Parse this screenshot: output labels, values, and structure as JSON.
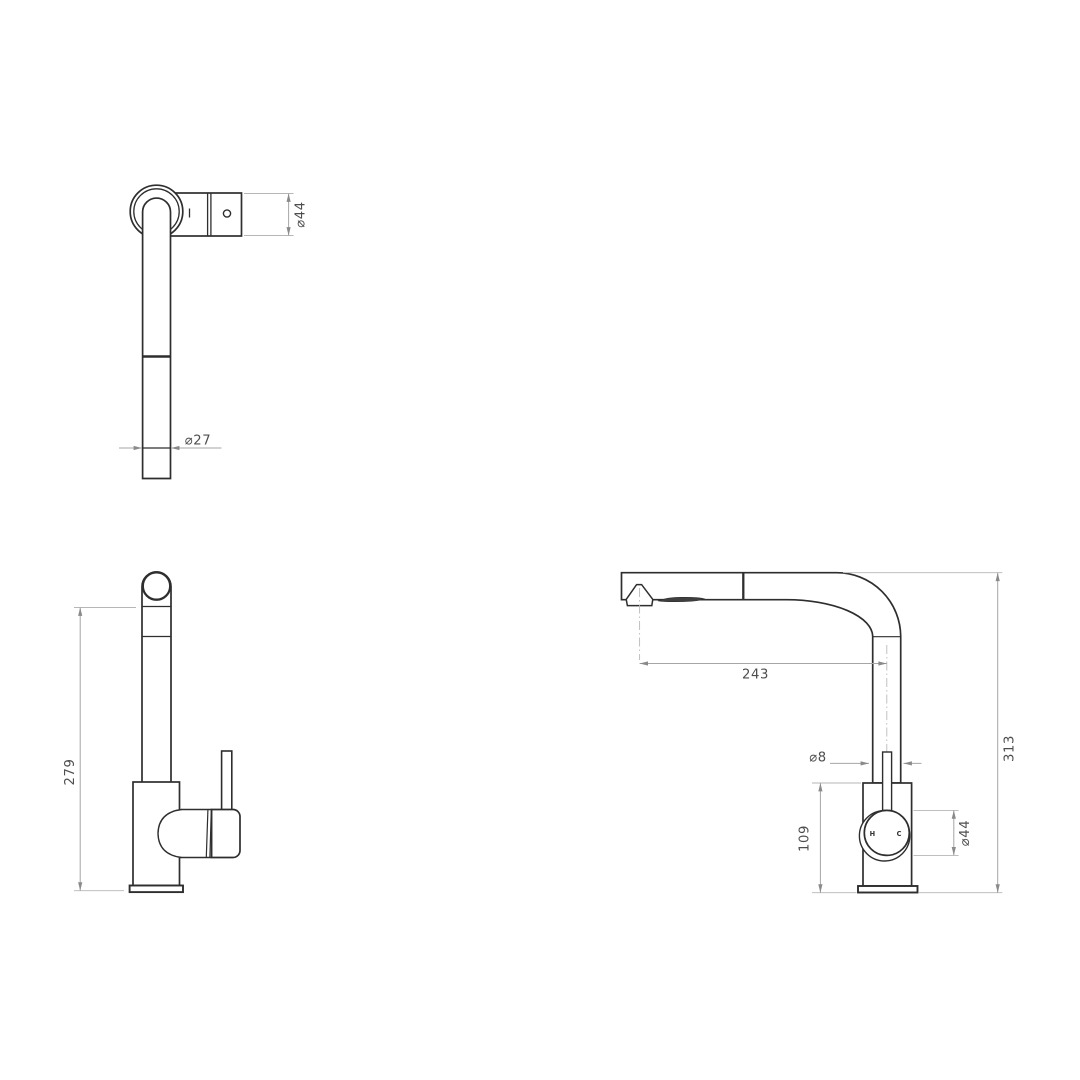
{
  "page": {
    "background": "#ffffff",
    "object_line_color": "#2e2e2e",
    "dimension_line_color": "#a6a6a6",
    "dimension_text_color": "#4e4e4e"
  },
  "drawing": {
    "type": "technical-dimension-drawing",
    "subject": "pull-out kitchen mixer tap, three orthographic views",
    "views": {
      "top": {
        "dims": {
          "spout_diameter": "⌀44",
          "tube_diameter": "⌀27"
        }
      },
      "front": {
        "dims": {
          "height_to_outlet": "279"
        }
      },
      "side": {
        "dims": {
          "spout_reach": "243",
          "overall_height": "313",
          "rod_diameter": "⌀8",
          "body_height": "109",
          "dial_diameter": "⌀44"
        },
        "labels": {
          "hot": "H",
          "cold": "C"
        }
      }
    }
  }
}
